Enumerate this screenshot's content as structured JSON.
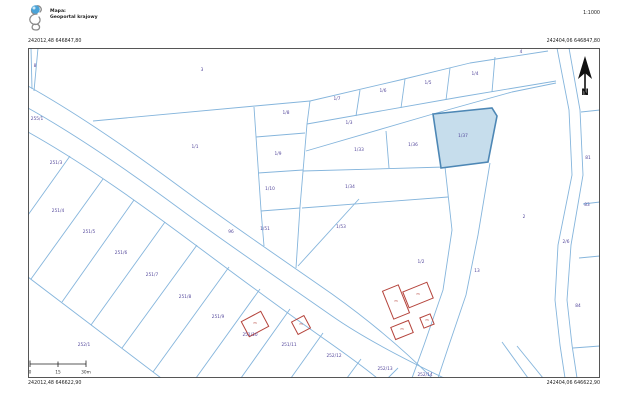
{
  "header": {
    "map_label": "Mapa:",
    "portal_name": "Geoportal krajowy",
    "scale": "1:1000"
  },
  "frame_coordinates": {
    "top_left": "242012,48 646847,80",
    "top_right": "242404,06 646847,80",
    "bottom_left": "242012,48 646622,90",
    "bottom_right": "242404,06 646622,90"
  },
  "north_arrow_label": "N",
  "scale_bar": {
    "labels": [
      "0",
      "15",
      "30m"
    ]
  },
  "map": {
    "colors": {
      "boundary_line": "#85b5dc",
      "parcel_label": "#53479b",
      "building_outline": "#b5443c",
      "highlight_fill": "#c6ddec",
      "highlight_stroke": "#4d87b5",
      "frame": "#444444"
    },
    "highlighted_parcel": {
      "id": "1/37"
    },
    "parcel_labels": [
      {
        "t": "8",
        "x": 35,
        "y": 67
      },
      {
        "t": "3",
        "x": 202,
        "y": 71
      },
      {
        "t": "255/1",
        "x": 37,
        "y": 120
      },
      {
        "t": "251/3",
        "x": 56,
        "y": 164
      },
      {
        "t": "251/4",
        "x": 58,
        "y": 212
      },
      {
        "t": "251/5",
        "x": 89,
        "y": 233
      },
      {
        "t": "251/6",
        "x": 121,
        "y": 254
      },
      {
        "t": "251/7",
        "x": 152,
        "y": 276
      },
      {
        "t": "251/8",
        "x": 185,
        "y": 298
      },
      {
        "t": "251/9",
        "x": 218,
        "y": 318
      },
      {
        "t": "251/10",
        "x": 250,
        "y": 336
      },
      {
        "t": "251/11",
        "x": 289,
        "y": 346
      },
      {
        "t": "252/1",
        "x": 84,
        "y": 346
      },
      {
        "t": "252/12",
        "x": 334,
        "y": 357
      },
      {
        "t": "252/13",
        "x": 385,
        "y": 370
      },
      {
        "t": "252/14",
        "x": 425,
        "y": 376
      },
      {
        "t": "96",
        "x": 231,
        "y": 233
      },
      {
        "t": "1/51",
        "x": 265,
        "y": 230
      },
      {
        "t": "1/53",
        "x": 341,
        "y": 228
      },
      {
        "t": "1/1",
        "x": 195,
        "y": 148
      },
      {
        "t": "1/8",
        "x": 286,
        "y": 114
      },
      {
        "t": "1/9",
        "x": 278,
        "y": 155
      },
      {
        "t": "1/10",
        "x": 270,
        "y": 190
      },
      {
        "t": "1/7",
        "x": 337,
        "y": 100
      },
      {
        "t": "1/6",
        "x": 383,
        "y": 92
      },
      {
        "t": "1/5",
        "x": 428,
        "y": 84
      },
      {
        "t": "1/4",
        "x": 475,
        "y": 75
      },
      {
        "t": "1/3",
        "x": 349,
        "y": 124
      },
      {
        "t": "1/33",
        "x": 359,
        "y": 151
      },
      {
        "t": "1/36",
        "x": 413,
        "y": 146
      },
      {
        "t": "1/34",
        "x": 350,
        "y": 188
      },
      {
        "t": "1/2",
        "x": 421,
        "y": 263
      },
      {
        "t": "13",
        "x": 477,
        "y": 272
      },
      {
        "t": "2",
        "x": 524,
        "y": 218
      },
      {
        "t": "2/6",
        "x": 566,
        "y": 243
      },
      {
        "t": "4",
        "x": 521,
        "y": 53
      },
      {
        "t": "81",
        "x": 588,
        "y": 159
      },
      {
        "t": "83",
        "x": 587,
        "y": 206
      },
      {
        "t": "84",
        "x": 578,
        "y": 307
      }
    ],
    "buildings": [
      {
        "label": "m",
        "x": 418,
        "y": 295
      },
      {
        "label": "m",
        "x": 396,
        "y": 302
      },
      {
        "label": "m",
        "x": 427,
        "y": 321
      },
      {
        "label": "m",
        "x": 402,
        "y": 330
      },
      {
        "label": "m",
        "x": 255,
        "y": 324
      },
      {
        "label": "m",
        "x": 301,
        "y": 325
      }
    ]
  }
}
